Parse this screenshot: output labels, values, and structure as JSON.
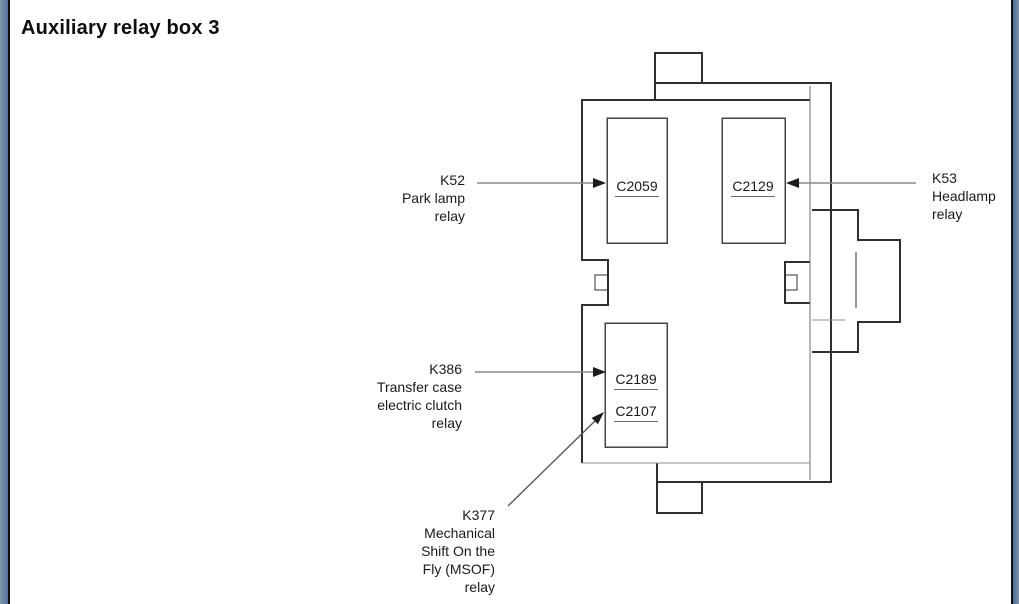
{
  "title": "Auxiliary relay box 3",
  "colors": {
    "background": "#ffffff",
    "frame_blue": "#5b7a9e",
    "frame_line": "#101010",
    "line_dark": "#2f2f2f",
    "line_gray": "#8f8f8f",
    "text": "#161616"
  },
  "diagram": {
    "connectors": [
      {
        "id": "c2059",
        "label": "C2059"
      },
      {
        "id": "c2129",
        "label": "C2129"
      },
      {
        "id": "c2189",
        "label": "C2189"
      },
      {
        "id": "c2107",
        "label": "C2107"
      }
    ],
    "relay_labels": [
      {
        "id": "k52",
        "points_to": "C2059",
        "lines": [
          "K52",
          "Park lamp",
          "relay"
        ]
      },
      {
        "id": "k53",
        "points_to": "C2129",
        "lines": [
          "K53",
          "Headlamp",
          "relay"
        ]
      },
      {
        "id": "k386",
        "points_to": "C2189",
        "lines": [
          "K386",
          "Transfer case",
          "electric clutch",
          "relay"
        ]
      },
      {
        "id": "k377",
        "points_to": "C2107",
        "lines": [
          "K377",
          "Mechanical",
          "Shift On the",
          "Fly (MSOF)",
          "relay"
        ]
      }
    ]
  }
}
